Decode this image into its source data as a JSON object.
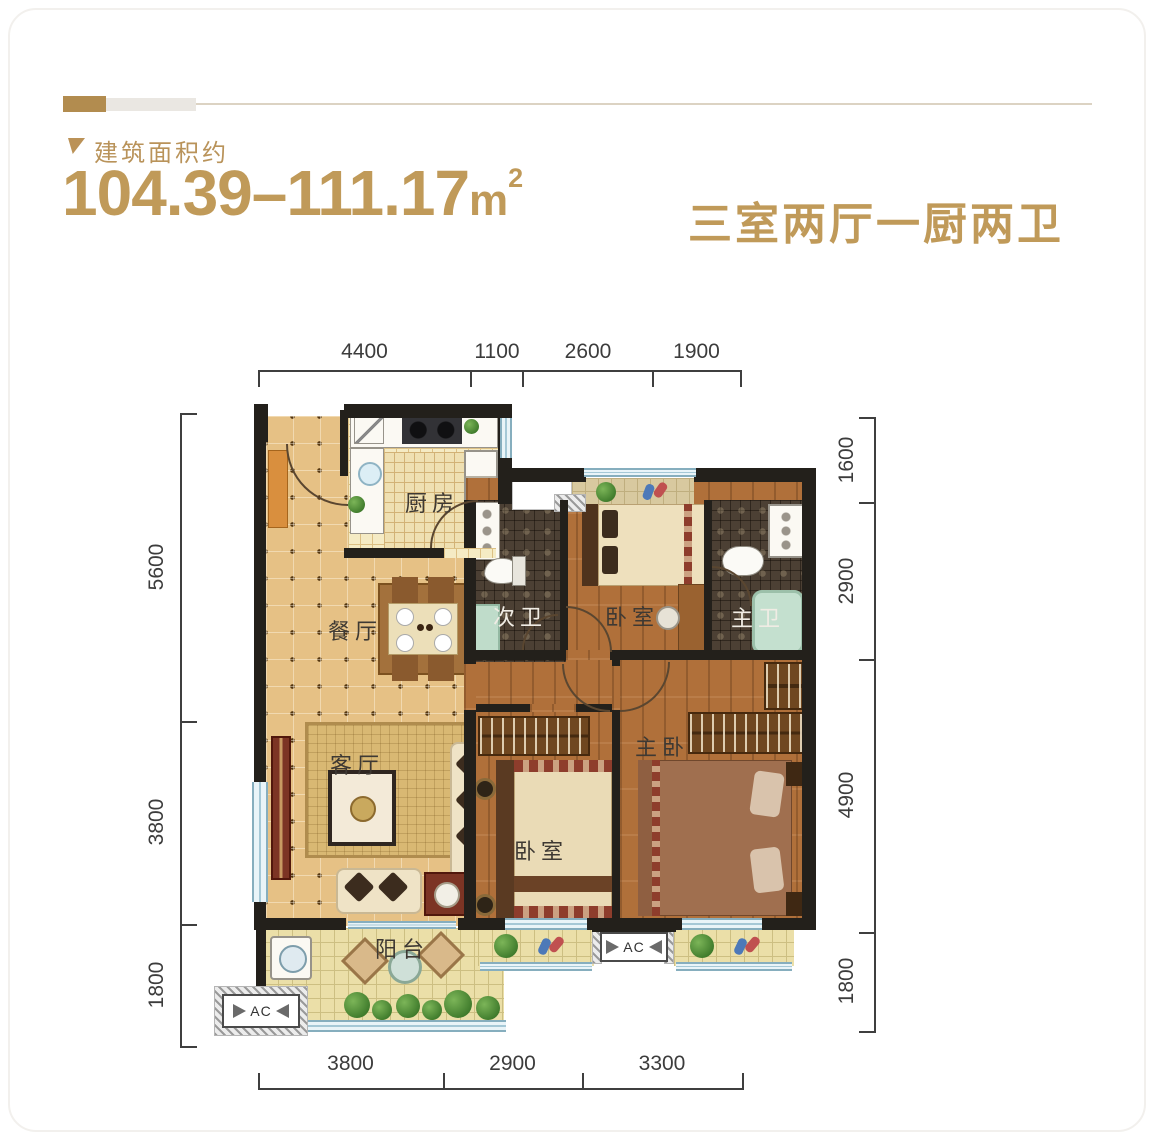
{
  "colors": {
    "accent": "#bf9a59",
    "wall": "#23201b",
    "dimension_text": "#3c3c3c"
  },
  "header": {
    "area_label": "建筑面积约",
    "area_value": "104.39–111.17",
    "area_unit": "m",
    "area_exponent": "2",
    "layout_title": "三室两厅一厨两卫"
  },
  "plan": {
    "rooms": {
      "kitchen": "厨房",
      "dining": "餐厅",
      "living": "客厅",
      "balcony": "阳台",
      "bath_secondary": "次卫",
      "bedroom_top": "卧室",
      "bath_master": "主卫",
      "master_bedroom": "主卧",
      "bedroom_bottom": "卧室"
    },
    "ac_label": "AC",
    "dimensions": {
      "top": [
        "4400",
        "1100",
        "2600",
        "1900"
      ],
      "bottom": [
        "3800",
        "2900",
        "3300"
      ],
      "left": [
        "5600",
        "3800",
        "1800"
      ],
      "right": [
        "1600",
        "2900",
        "4900",
        "1800"
      ]
    }
  }
}
